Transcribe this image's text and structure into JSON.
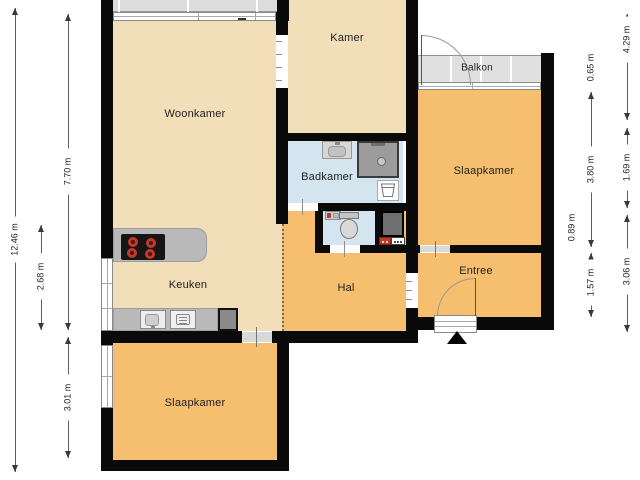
{
  "rooms": {
    "woonkamer": "Woonkamer",
    "kamer": "Kamer",
    "badkamer": "Badkamer",
    "balkon": "Balkon",
    "slaapkamer_right": "Slaapkamer",
    "keuken": "Keuken",
    "hal": "Hal",
    "entree": "Entree",
    "slaapkamer_bottom": "Slaapkamer"
  },
  "dimensions": [
    {
      "label": "12.46 m",
      "x": 15,
      "y1": 8,
      "y2": 472,
      "ly": 240
    },
    {
      "label": "7.70 m",
      "x": 68,
      "y1": 14,
      "y2": 330,
      "ly": 172
    },
    {
      "label": "2.68 m",
      "x": 41,
      "y1": 225,
      "y2": 330,
      "ly": 277
    },
    {
      "label": "3.01 m",
      "x": 68,
      "y1": 337,
      "y2": 458,
      "ly": 398
    },
    {
      "label": "0.65 m",
      "x": 591,
      "y1": 55,
      "y2": 82,
      "ly": 68
    },
    {
      "label": "3.80 m",
      "x": 591,
      "y1": 92,
      "y2": 247,
      "ly": 170
    },
    {
      "label": "1.57 m",
      "x": 591,
      "y1": 253,
      "y2": 317,
      "ly": 283
    },
    {
      "label": "0.89 m",
      "x": 572,
      "y1": 211,
      "y2": 247,
      "ly": 228
    },
    {
      "label": "4.29 m",
      "x": 627,
      "y1": 14,
      "y2": 120,
      "ly": 40
    },
    {
      "label": "1.69 m",
      "x": 627,
      "y1": 128,
      "y2": 208,
      "ly": 168
    },
    {
      "label": "3.06 m",
      "x": 627,
      "y1": 215,
      "y2": 332,
      "ly": 272
    }
  ],
  "colors": {
    "wall": "#0a0a0a",
    "floor_living": "#f2deb8",
    "floor_rooms": "#f5bf6f",
    "floor_wet": "#d5e5f0",
    "balcony": "#e0e0e0",
    "accent_red": "#c0392b"
  }
}
